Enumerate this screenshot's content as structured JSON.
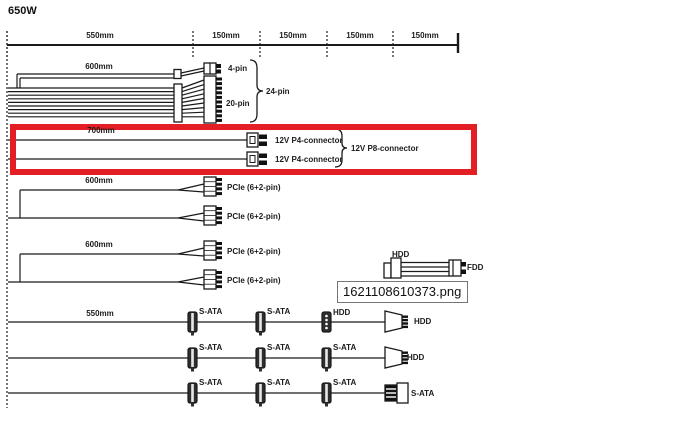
{
  "title": "650W",
  "colors": {
    "highlight_red": "#e31e24",
    "line": "#1a1a1a"
  },
  "ruler": {
    "labels": [
      "550mm",
      "150mm",
      "150mm",
      "150mm",
      "150mm"
    ]
  },
  "bundles": {
    "atx": {
      "length": "600mm",
      "four_pin": "4-pin",
      "twenty_pin": "20-pin",
      "total": "24-pin"
    },
    "cpu": {
      "length": "700mm",
      "p4_top": "12V P4-connector",
      "p4_bottom": "12V P4-connector",
      "p8": "12V P8-connector"
    },
    "pcie1": {
      "length": "600mm",
      "top": "PCIe (6+2-pin)",
      "bottom": "PCIe (6+2-pin)"
    },
    "pcie2": {
      "length": "600mm",
      "top": "PCIe (6+2-pin)",
      "bottom": "PCIe (6+2-pin)"
    },
    "peripheral": {
      "hdd": "HDD",
      "fdd": "FDD"
    },
    "sata1": {
      "length": "550mm",
      "c1": "S-ATA",
      "c2": "S-ATA",
      "c3": "HDD",
      "end": "HDD"
    },
    "sata2": {
      "c1": "S-ATA",
      "c2": "S-ATA",
      "c3": "S-ATA",
      "end": "HDD"
    },
    "sata3": {
      "c1": "S-ATA",
      "c2": "S-ATA",
      "c3": "S-ATA",
      "end": "S-ATA"
    }
  },
  "tooltip": {
    "filename": "1621108610373.png"
  }
}
